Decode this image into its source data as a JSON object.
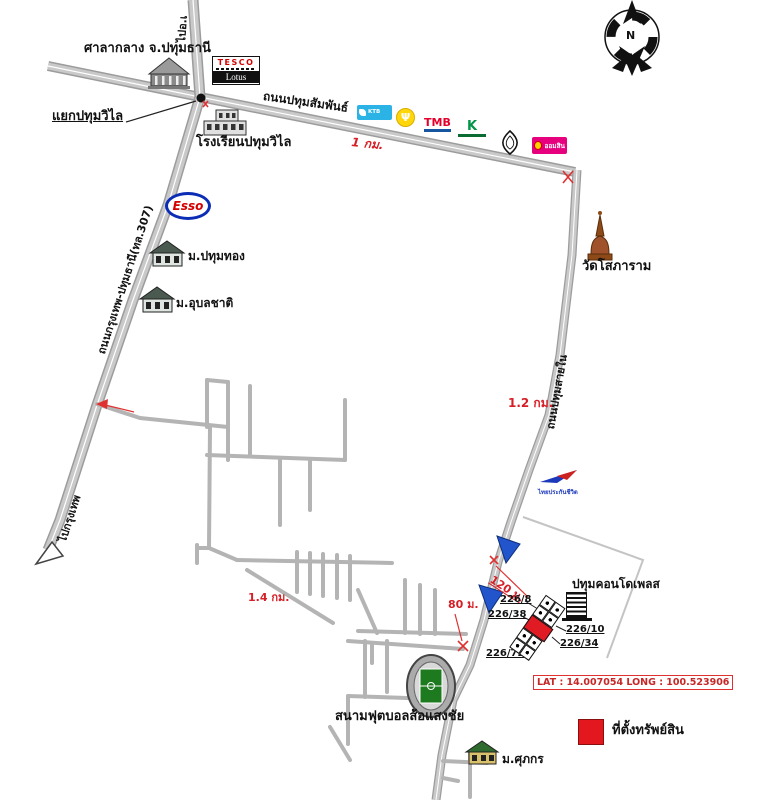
{
  "compass": {
    "north": "N"
  },
  "roads": {
    "pathum_samphan": {
      "label": "ถนนปทุมสัมพันธ์"
    },
    "bangkok_pathum": {
      "label": "ถนนกรุงเทพ-ปทุมธานี(ทล.307)"
    },
    "pathum_sai_nai": {
      "label": "ถนนปทุมสายใน"
    },
    "to_bangkok": {
      "label": "ไปกรุงเทพ"
    },
    "to_amphoe": {
      "label": "ไปอ.เ"
    },
    "junction_pathum_wilai": {
      "label": "แยกปทุมวิไล"
    }
  },
  "places": {
    "city_hall": {
      "label": "ศาลากลาง จ.ปทุมธานี"
    },
    "tesco": {
      "line1": "TESCO",
      "line2": "Lotus"
    },
    "school": {
      "label": "โรงเรียนปทุมวิไล"
    },
    "esso": {
      "label": "Esso"
    },
    "ktb_bank": {
      "label": "KTB"
    },
    "tmb_bank": {
      "label": "TMB"
    },
    "gsb_bank": {
      "label": "ออมสิน"
    },
    "thai_life": {
      "label": "ไทยประกันชีวิต"
    },
    "wat_sopharam": {
      "label": "วัดโสภาราม"
    },
    "moo_pathum_thong": {
      "label": "ม.ปทุมทอง"
    },
    "moo_ubon_chat": {
      "label": "ม.อุบลชาติ"
    },
    "moo_supakorn": {
      "label": "ม.ศุภกร"
    },
    "condo": {
      "label": "ปทุมคอนโดเพลส"
    },
    "stadium": {
      "label": "สนามฟุตบอลส้อแสงชัย"
    }
  },
  "distances": {
    "samphan_1km": "1 กม.",
    "sai_nai_1_2km": "1.2 กม.",
    "lane_1_4km": "1.4 กม.",
    "last_120m": "120 ม.",
    "last_80m": "80 ม."
  },
  "addresses": {
    "h226_8": "226/8",
    "h226_38": "226/38",
    "h226_72": "226/72",
    "h226_10": "226/10",
    "h226_34": "226/34"
  },
  "property": {
    "lat_long": "LAT : 14.007054  LONG : 100.523906",
    "legend_label": "ที่ตั้งทรัพย์สิน",
    "marker_color": "#e3171e"
  },
  "icons": {
    "krungsri_mark": "Ψ"
  },
  "colors": {
    "road_gray": "#c9c9c9",
    "accent_red": "#d61f26",
    "arrow_blue": "#2255cc",
    "gsb_pink": "#e6007e",
    "kbank_green": "#029447",
    "tmb_red": "#e4002b",
    "krungsri_yellow": "#ffd60a",
    "ktb_blue": "#2ab3e4"
  }
}
